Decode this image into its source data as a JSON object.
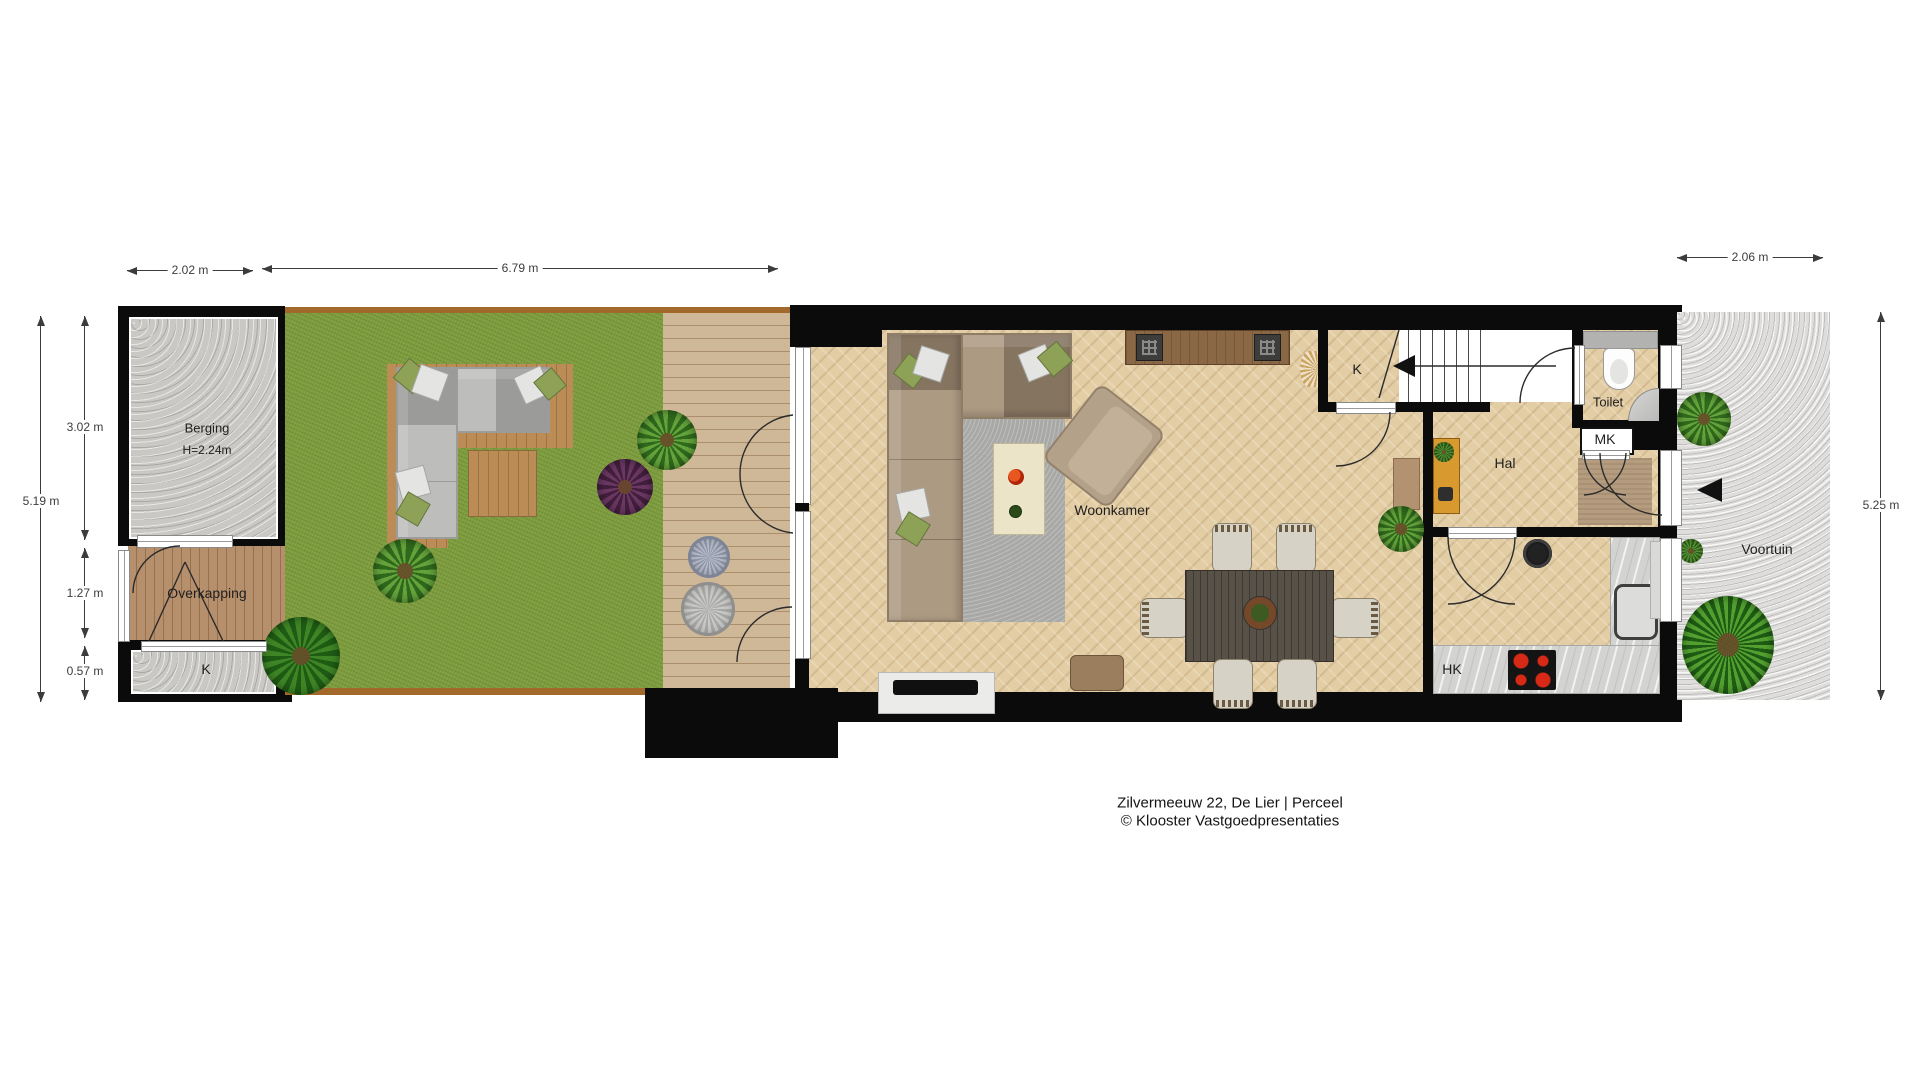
{
  "caption": {
    "line1": "Zilvermeeuw 22, De Lier | Perceel",
    "line2": "© Klooster Vastgoedpresentaties"
  },
  "labels": {
    "berging": "Berging",
    "berging_height": "H=2.24m",
    "overkapping": "Overkapping",
    "k_left": "K",
    "woonkamer": "Woonkamer",
    "k_closet": "K",
    "toilet": "Toilet",
    "mk": "MK",
    "hal": "Hal",
    "hk": "HK",
    "voortuin": "Voortuin"
  },
  "measurements": {
    "shed_width": "2.02 m",
    "garden_width": "6.79 m",
    "frontyard_width": "2.06 m",
    "left_total_depth": "5.19 m",
    "shed_depth": "3.02 m",
    "overkapping_depth": "1.27 m",
    "k_depth": "0.57 m",
    "frontyard_depth": "5.25 m"
  },
  "icons": {
    "stairs_direction_arrow": "left-triangle",
    "entrance_arrow": "left-triangle"
  },
  "colors": {
    "wall": "#0b0b0b",
    "grass": "#7d9c40",
    "interior_floor": "#e3cda4",
    "gravel": "#dedddb",
    "concrete": "#c9c8c4",
    "accent_cabinet_orange": "#d89a2f",
    "hob_burner_red": "#d62a17",
    "dim_text": "#3c3c3c"
  }
}
